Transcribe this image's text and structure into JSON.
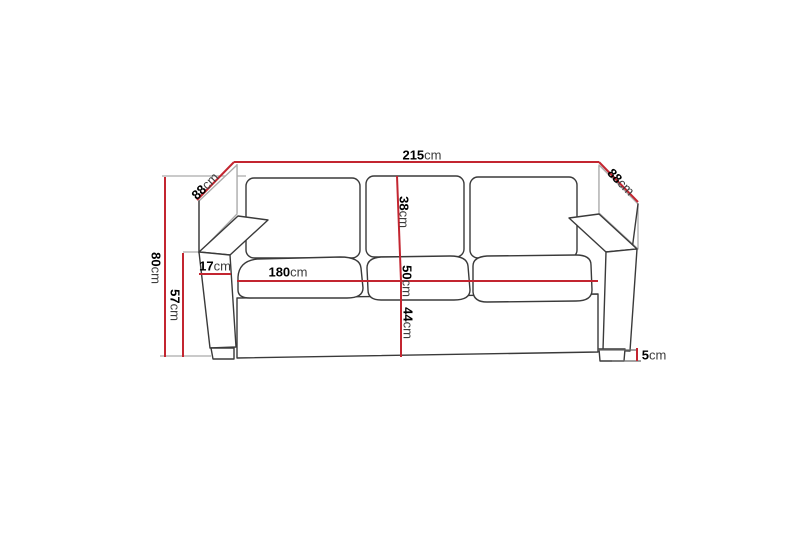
{
  "page": {
    "background": "#ffffff"
  },
  "diagram": {
    "title": "3-seat sofa dimension diagram",
    "subject": "three-seat sofa, front perspective line drawing",
    "unit": "cm",
    "colors": {
      "background": "#ffffff",
      "dimension_line": "#c32530",
      "sketch_line": "#3a3a3a",
      "extension_line": "#ababab",
      "label_number": "#000000",
      "label_unit": "#3c3c3c"
    },
    "labels": {
      "overall_width": {
        "value": "215",
        "unit": "cm",
        "meaning": "overall width"
      },
      "depth_left": {
        "value": "88",
        "unit": "cm",
        "meaning": "overall depth (left side)"
      },
      "depth_right": {
        "value": "88",
        "unit": "cm",
        "meaning": "overall depth (right side)"
      },
      "overall_height": {
        "value": "80",
        "unit": "cm",
        "meaning": "overall height"
      },
      "armrest_height": {
        "value": "57",
        "unit": "cm",
        "meaning": "armrest height"
      },
      "armrest_width": {
        "value": "17",
        "unit": "cm",
        "meaning": "armrest width"
      },
      "seat_width": {
        "value": "180",
        "unit": "cm",
        "meaning": "seat width"
      },
      "back_cushion_height": {
        "value": "38",
        "unit": "cm",
        "meaning": "back cushion height"
      },
      "seat_depth": {
        "value": "50",
        "unit": "cm",
        "meaning": "seat depth"
      },
      "seat_height": {
        "value": "44",
        "unit": "cm",
        "meaning": "seat height"
      },
      "leg_height": {
        "value": "5",
        "unit": "cm",
        "meaning": "leg height"
      }
    }
  }
}
